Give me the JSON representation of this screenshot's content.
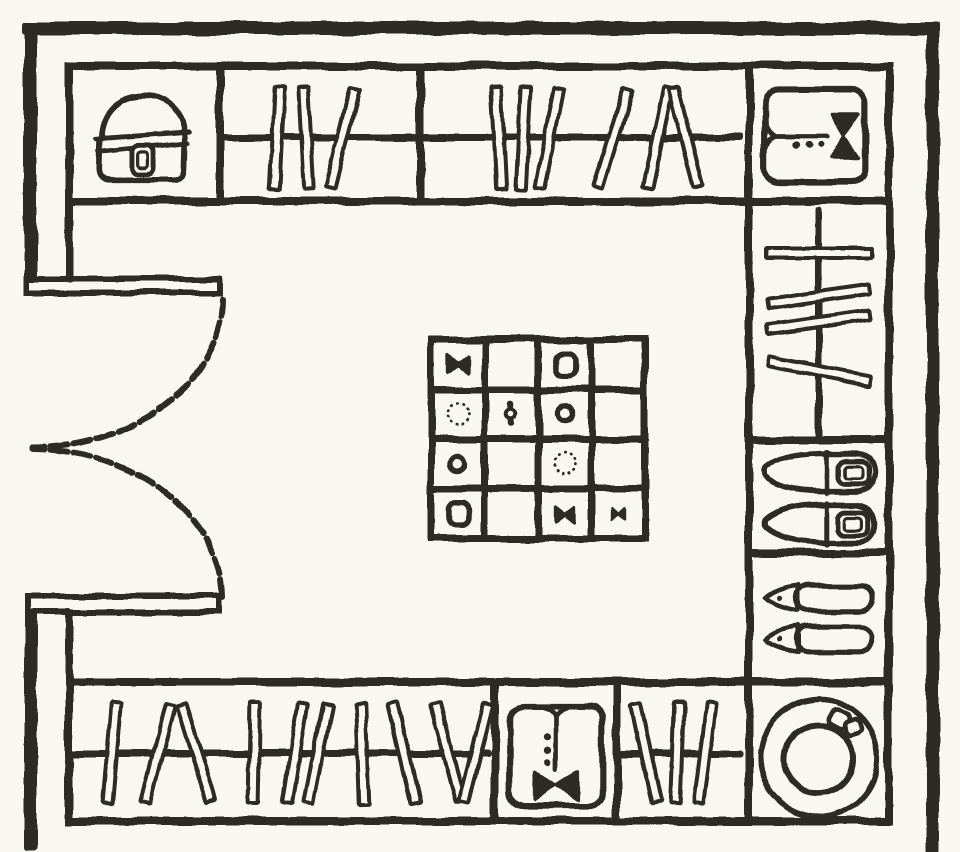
{
  "colors": {
    "ink": "#2d2a25",
    "paper": "#f8f7f2"
  },
  "door": {
    "type": "double-swing-door",
    "leaf_count": 2
  },
  "top_band": {
    "compartments": [
      "handbag-shelf",
      "hanging-rail",
      "hanging-rail",
      "folded-shirt-shelf"
    ],
    "rail_a_clothes": [
      {
        "x": 277,
        "rot": 3
      },
      {
        "x": 306,
        "rot": -3
      },
      {
        "x": 343,
        "rot": 14
      }
    ],
    "rail_b_clothes": [
      {
        "x": 499,
        "rot": -3
      },
      {
        "x": 523,
        "rot": 3
      },
      {
        "x": 549,
        "rot": 11
      },
      {
        "x": 613,
        "rot": 17
      },
      {
        "x": 658,
        "rot": 12
      },
      {
        "x": 686,
        "rot": -14
      }
    ]
  },
  "right_column": {
    "compartments": [
      "folded-shirt-shelf",
      "side-hanging-rail",
      "buckled-shoes-shelf",
      "pointed-flats-shelf",
      "hat-shelf"
    ],
    "rail_clothes": [
      {
        "y": 253,
        "rot": 0
      },
      {
        "y": 296,
        "rot": -8
      },
      {
        "y": 322,
        "rot": -8
      },
      {
        "y": 371,
        "rot": 11
      }
    ]
  },
  "bottom_band": {
    "compartments": [
      "hanging-rail",
      "folded-shirt-shelf",
      "hanging-rail",
      "hat-shelf"
    ],
    "rail_a_clothes": [
      {
        "x": 112,
        "rot": 5
      },
      {
        "x": 158,
        "rot": 14
      },
      {
        "x": 196,
        "rot": -17
      },
      {
        "x": 254,
        "rot": 1
      },
      {
        "x": 295,
        "rot": 9
      },
      {
        "x": 318,
        "rot": 11
      },
      {
        "x": 362,
        "rot": -2
      },
      {
        "x": 404,
        "rot": -13
      },
      {
        "x": 448,
        "rot": -15
      },
      {
        "x": 476,
        "rot": 14
      }
    ],
    "rail_b_clothes": [
      {
        "x": 646,
        "rot": -12
      },
      {
        "x": 677,
        "rot": 2
      },
      {
        "x": 705,
        "rot": 7
      }
    ]
  },
  "island": {
    "rows": 4,
    "cols": 4,
    "items": [
      {
        "row": 1,
        "col": 1,
        "type": "bowtie"
      },
      {
        "row": 1,
        "col": 3,
        "type": "rounded-box"
      },
      {
        "row": 2,
        "col": 1,
        "type": "dotted-circle"
      },
      {
        "row": 2,
        "col": 2,
        "type": "barbell"
      },
      {
        "row": 2,
        "col": 3,
        "type": "ring"
      },
      {
        "row": 3,
        "col": 1,
        "type": "ring"
      },
      {
        "row": 3,
        "col": 3,
        "type": "dotted-circle"
      },
      {
        "row": 4,
        "col": 1,
        "type": "rounded-box"
      },
      {
        "row": 4,
        "col": 3,
        "type": "bowtie"
      },
      {
        "row": 4,
        "col": 4,
        "type": "bowtie-small"
      }
    ]
  }
}
